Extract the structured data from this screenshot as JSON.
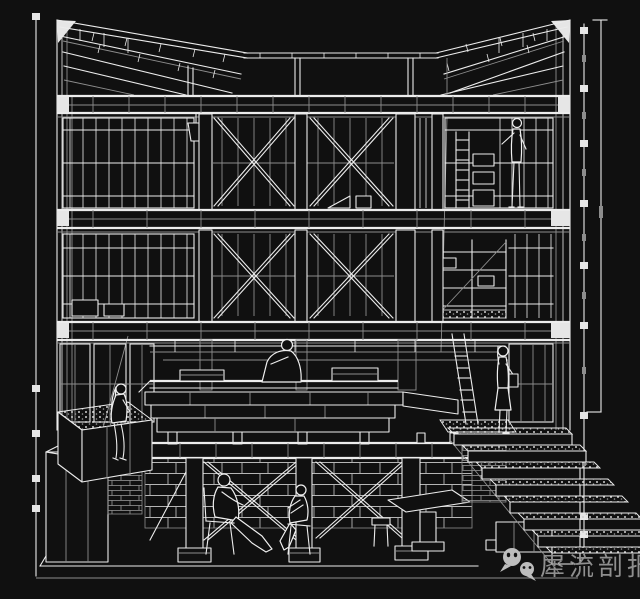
{
  "canvas": {
    "width": 640,
    "height": 599,
    "background": "#101010"
  },
  "drawing": {
    "type": "architectural-sectional-perspective",
    "stroke_color": "#ececec",
    "secondary_stroke_color": "#8d8d8d",
    "subject": "White-on-black cut-away sectional perspective of a three-storey frame building: fanned roof joists, glazed storeys with X-bracing, hanging lamp, ladders and shelving, central timber platform with seated figure, planter with seated figure, side stair, basement columns with braced frames and two seated figures"
  },
  "dimension_rules": {
    "right_rule_marker_count": 9,
    "left_rule_marker_count": 5
  },
  "watermark": {
    "text": "犀流剖报",
    "color": "#8f8f8f",
    "icon": "wechat-logo"
  }
}
